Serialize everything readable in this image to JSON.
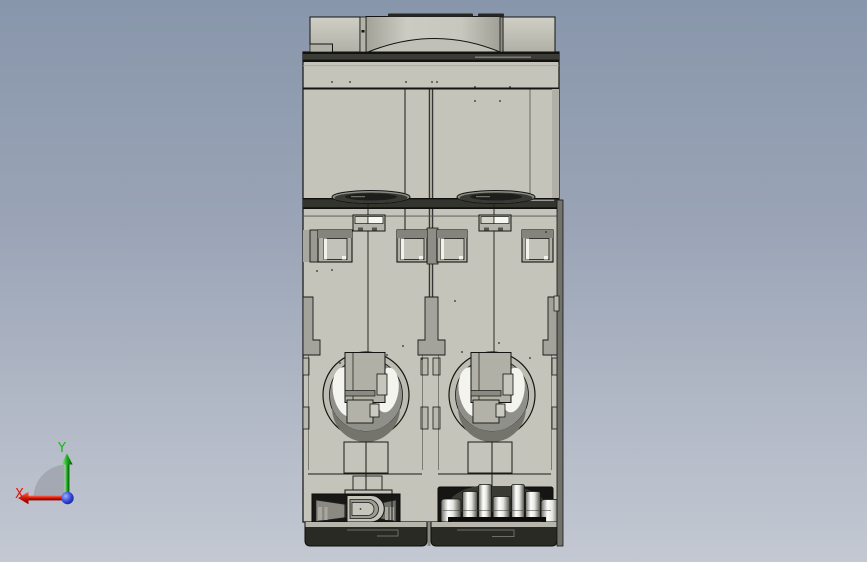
{
  "viewport": {
    "background_top": "#8896ab",
    "background_bottom": "#c3c8d2"
  },
  "triad": {
    "x_axis": {
      "label": "X",
      "color": "#dd1505",
      "direction": "left"
    },
    "y_axis": {
      "label": "Y",
      "color": "#17b517",
      "direction": "up"
    },
    "z_axis": {
      "color": "#2e42c8",
      "direction": "out-of-screen"
    }
  },
  "model": {
    "name": "two-pole-circuit-breaker-back-view",
    "pole_count": 2,
    "body_color": "#c4c4ba",
    "dark_band_color": "#34342f",
    "outline_color": "#141412",
    "highlight_color": "#f4f4ee",
    "metal_color": "#ffffff",
    "base_color": "#2a2a25"
  }
}
